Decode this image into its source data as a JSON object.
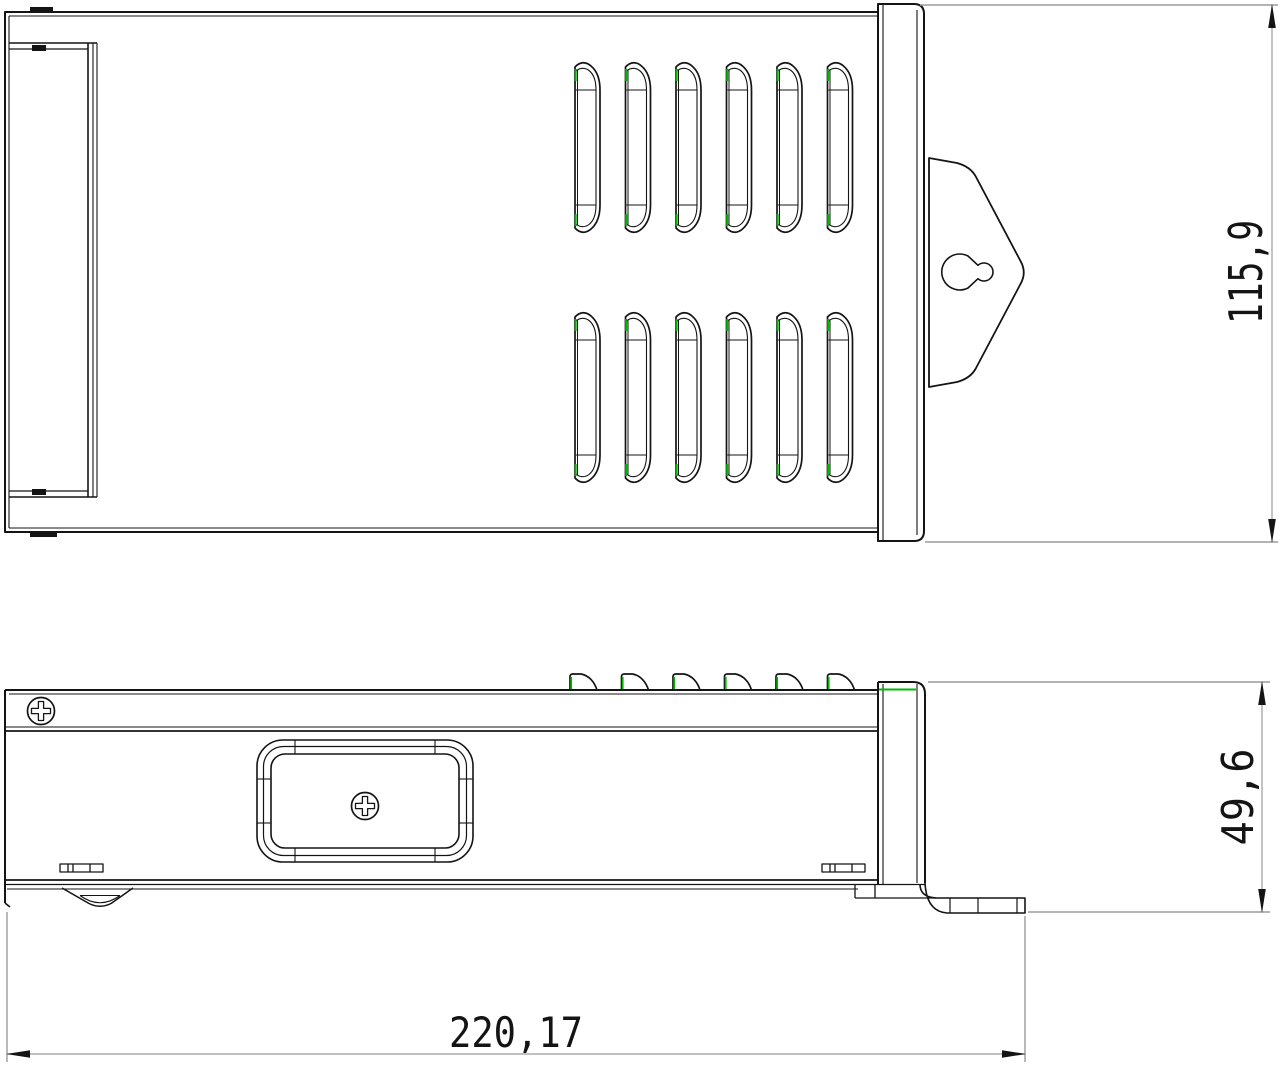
{
  "dimensions": {
    "overall_length": "220,17",
    "housing_height": "115,9",
    "profile_height": "49,6"
  },
  "colors": {
    "line": "#141414",
    "dim": "#9b9b9b",
    "green": "#00b800",
    "bg": "#ffffff"
  }
}
